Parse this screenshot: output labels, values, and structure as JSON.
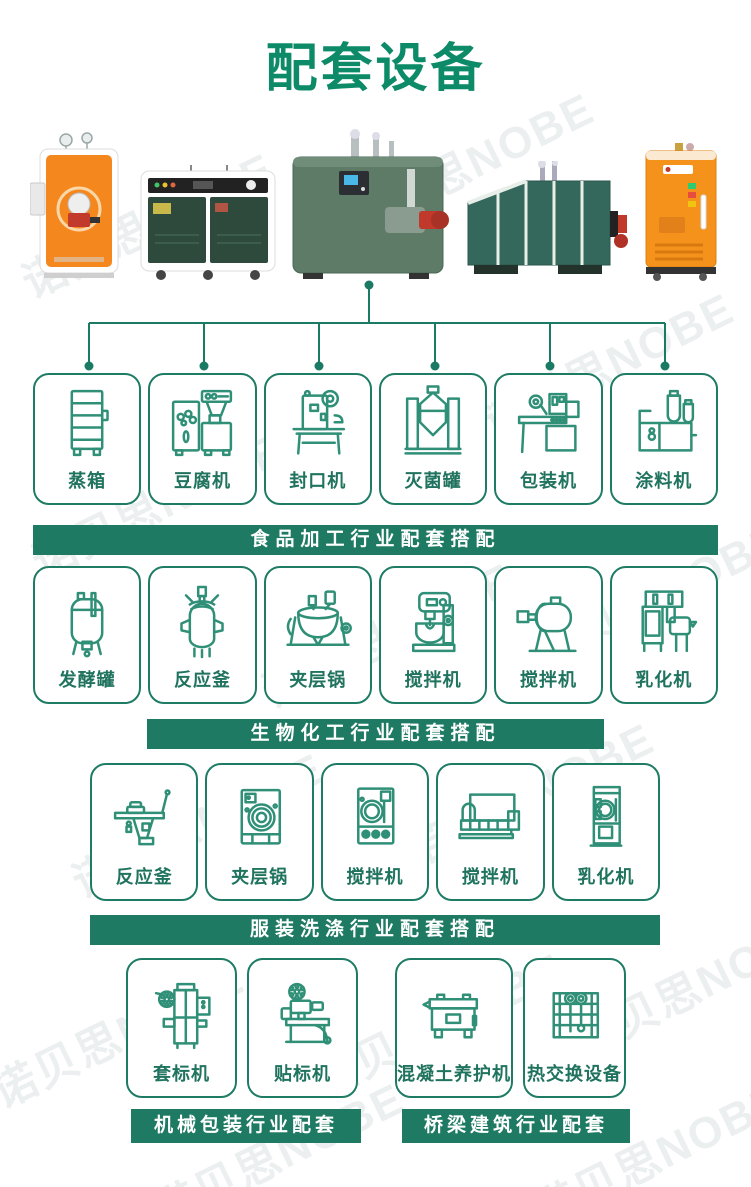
{
  "title": {
    "text": "配套设备"
  },
  "watermark": {
    "text": "诺贝思NOBE"
  },
  "machines": [
    {
      "name": "orange-vertical-boiler"
    },
    {
      "name": "green-cabinet-boiler"
    },
    {
      "name": "green-cube-boiler"
    },
    {
      "name": "teal-horizontal-boiler"
    },
    {
      "name": "orange-compact-boiler"
    }
  ],
  "sections": [
    {
      "banner": "食品加工行业配套搭配",
      "items": [
        {
          "label": "蒸箱",
          "icon": "steam-cabinet-icon"
        },
        {
          "label": "豆腐机",
          "icon": "tofu-machine-icon"
        },
        {
          "label": "封口机",
          "icon": "sealing-machine-icon"
        },
        {
          "label": "灭菌罐",
          "icon": "sterilizer-tank-icon"
        },
        {
          "label": "包装机",
          "icon": "packing-machine-icon"
        },
        {
          "label": "涂料机",
          "icon": "coating-machine-icon"
        }
      ]
    },
    {
      "banner": "生物化工行业配套搭配",
      "items": [
        {
          "label": "发酵罐",
          "icon": "fermenter-tank-icon"
        },
        {
          "label": "反应釜",
          "icon": "reactor-kettle-icon"
        },
        {
          "label": "夹层锅",
          "icon": "jacketed-kettle-icon"
        },
        {
          "label": "搅拌机",
          "icon": "planetary-mixer-icon"
        },
        {
          "label": "搅拌机",
          "icon": "drum-mixer-icon"
        },
        {
          "label": "乳化机",
          "icon": "emulsifier-icon"
        }
      ]
    },
    {
      "banner": "服装洗涤行业配套搭配",
      "items": [
        {
          "label": "反应釜",
          "icon": "ironing-table-icon"
        },
        {
          "label": "夹层锅",
          "icon": "washer-front-icon"
        },
        {
          "label": "搅拌机",
          "icon": "dryer-front-icon"
        },
        {
          "label": "搅拌机",
          "icon": "flatwork-ironer-icon"
        },
        {
          "label": "乳化机",
          "icon": "vertical-dryer-icon"
        }
      ]
    }
  ],
  "bottom_sections": [
    {
      "banner": "机械包装行业配套",
      "items": [
        {
          "label": "套标机",
          "icon": "sleeve-labeler-icon"
        },
        {
          "label": "贴标机",
          "icon": "labeling-machine-icon"
        }
      ]
    },
    {
      "banner": "桥梁建筑行业配套",
      "items": [
        {
          "label": "混凝土养护机",
          "icon": "concrete-curer-icon"
        },
        {
          "label": "热交换设备",
          "icon": "heat-exchanger-icon"
        }
      ]
    }
  ],
  "colors": {
    "title_green": "#0d8a68",
    "banner_green": "#1e7a63",
    "box_border": "#1e7c65",
    "icon_stroke": "#2f8f77",
    "label_green": "#20735e",
    "connector": "#1a7a64"
  }
}
